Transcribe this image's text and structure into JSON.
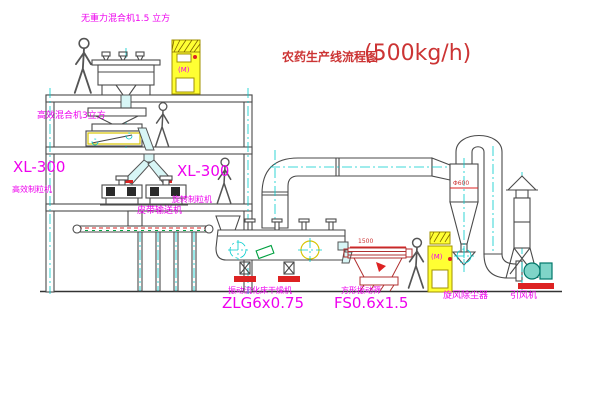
{
  "title": {
    "text": "农药生产线流程图",
    "capacity": "(500kg/h)"
  },
  "equipment": {
    "top_mixer": {
      "label": "无重力混合机1.5 立方"
    },
    "high_mixer": {
      "label": "高效混合机3立方"
    },
    "granulator_left": {
      "model": "XL-300",
      "name": "高效制粒机"
    },
    "granulator_right": {
      "model": "XL-300",
      "name": "旋转制粒机"
    },
    "belt_conveyor": {
      "label": "皮带输送机"
    },
    "dryer": {
      "name": "振动流化床干燥机",
      "model": "ZLG6x0.75"
    },
    "screen": {
      "name": "方形振动筛",
      "model": "FS0.6x1.5"
    },
    "cyclone": {
      "label": "旋风除尘器",
      "diameter": "Φ600"
    },
    "fan": {
      "label": "引风机"
    }
  },
  "annotations": {
    "dim_screen": "1500",
    "cabinet_marking": "(M)"
  },
  "icons": {
    "person": "walking-person-figure",
    "cabinet": "electrical-control-cabinet",
    "motor": "circle-cross-motor-symbol"
  },
  "colors": {
    "label_magenta": "#ee00ee",
    "title_red": "#cc3434",
    "centerline_cyan": "#00cccc",
    "cabinet_yellow": "#ffff33",
    "line_dark": "#4a4a4a",
    "accent_red": "#dd2222",
    "accent_green": "#00a040"
  }
}
